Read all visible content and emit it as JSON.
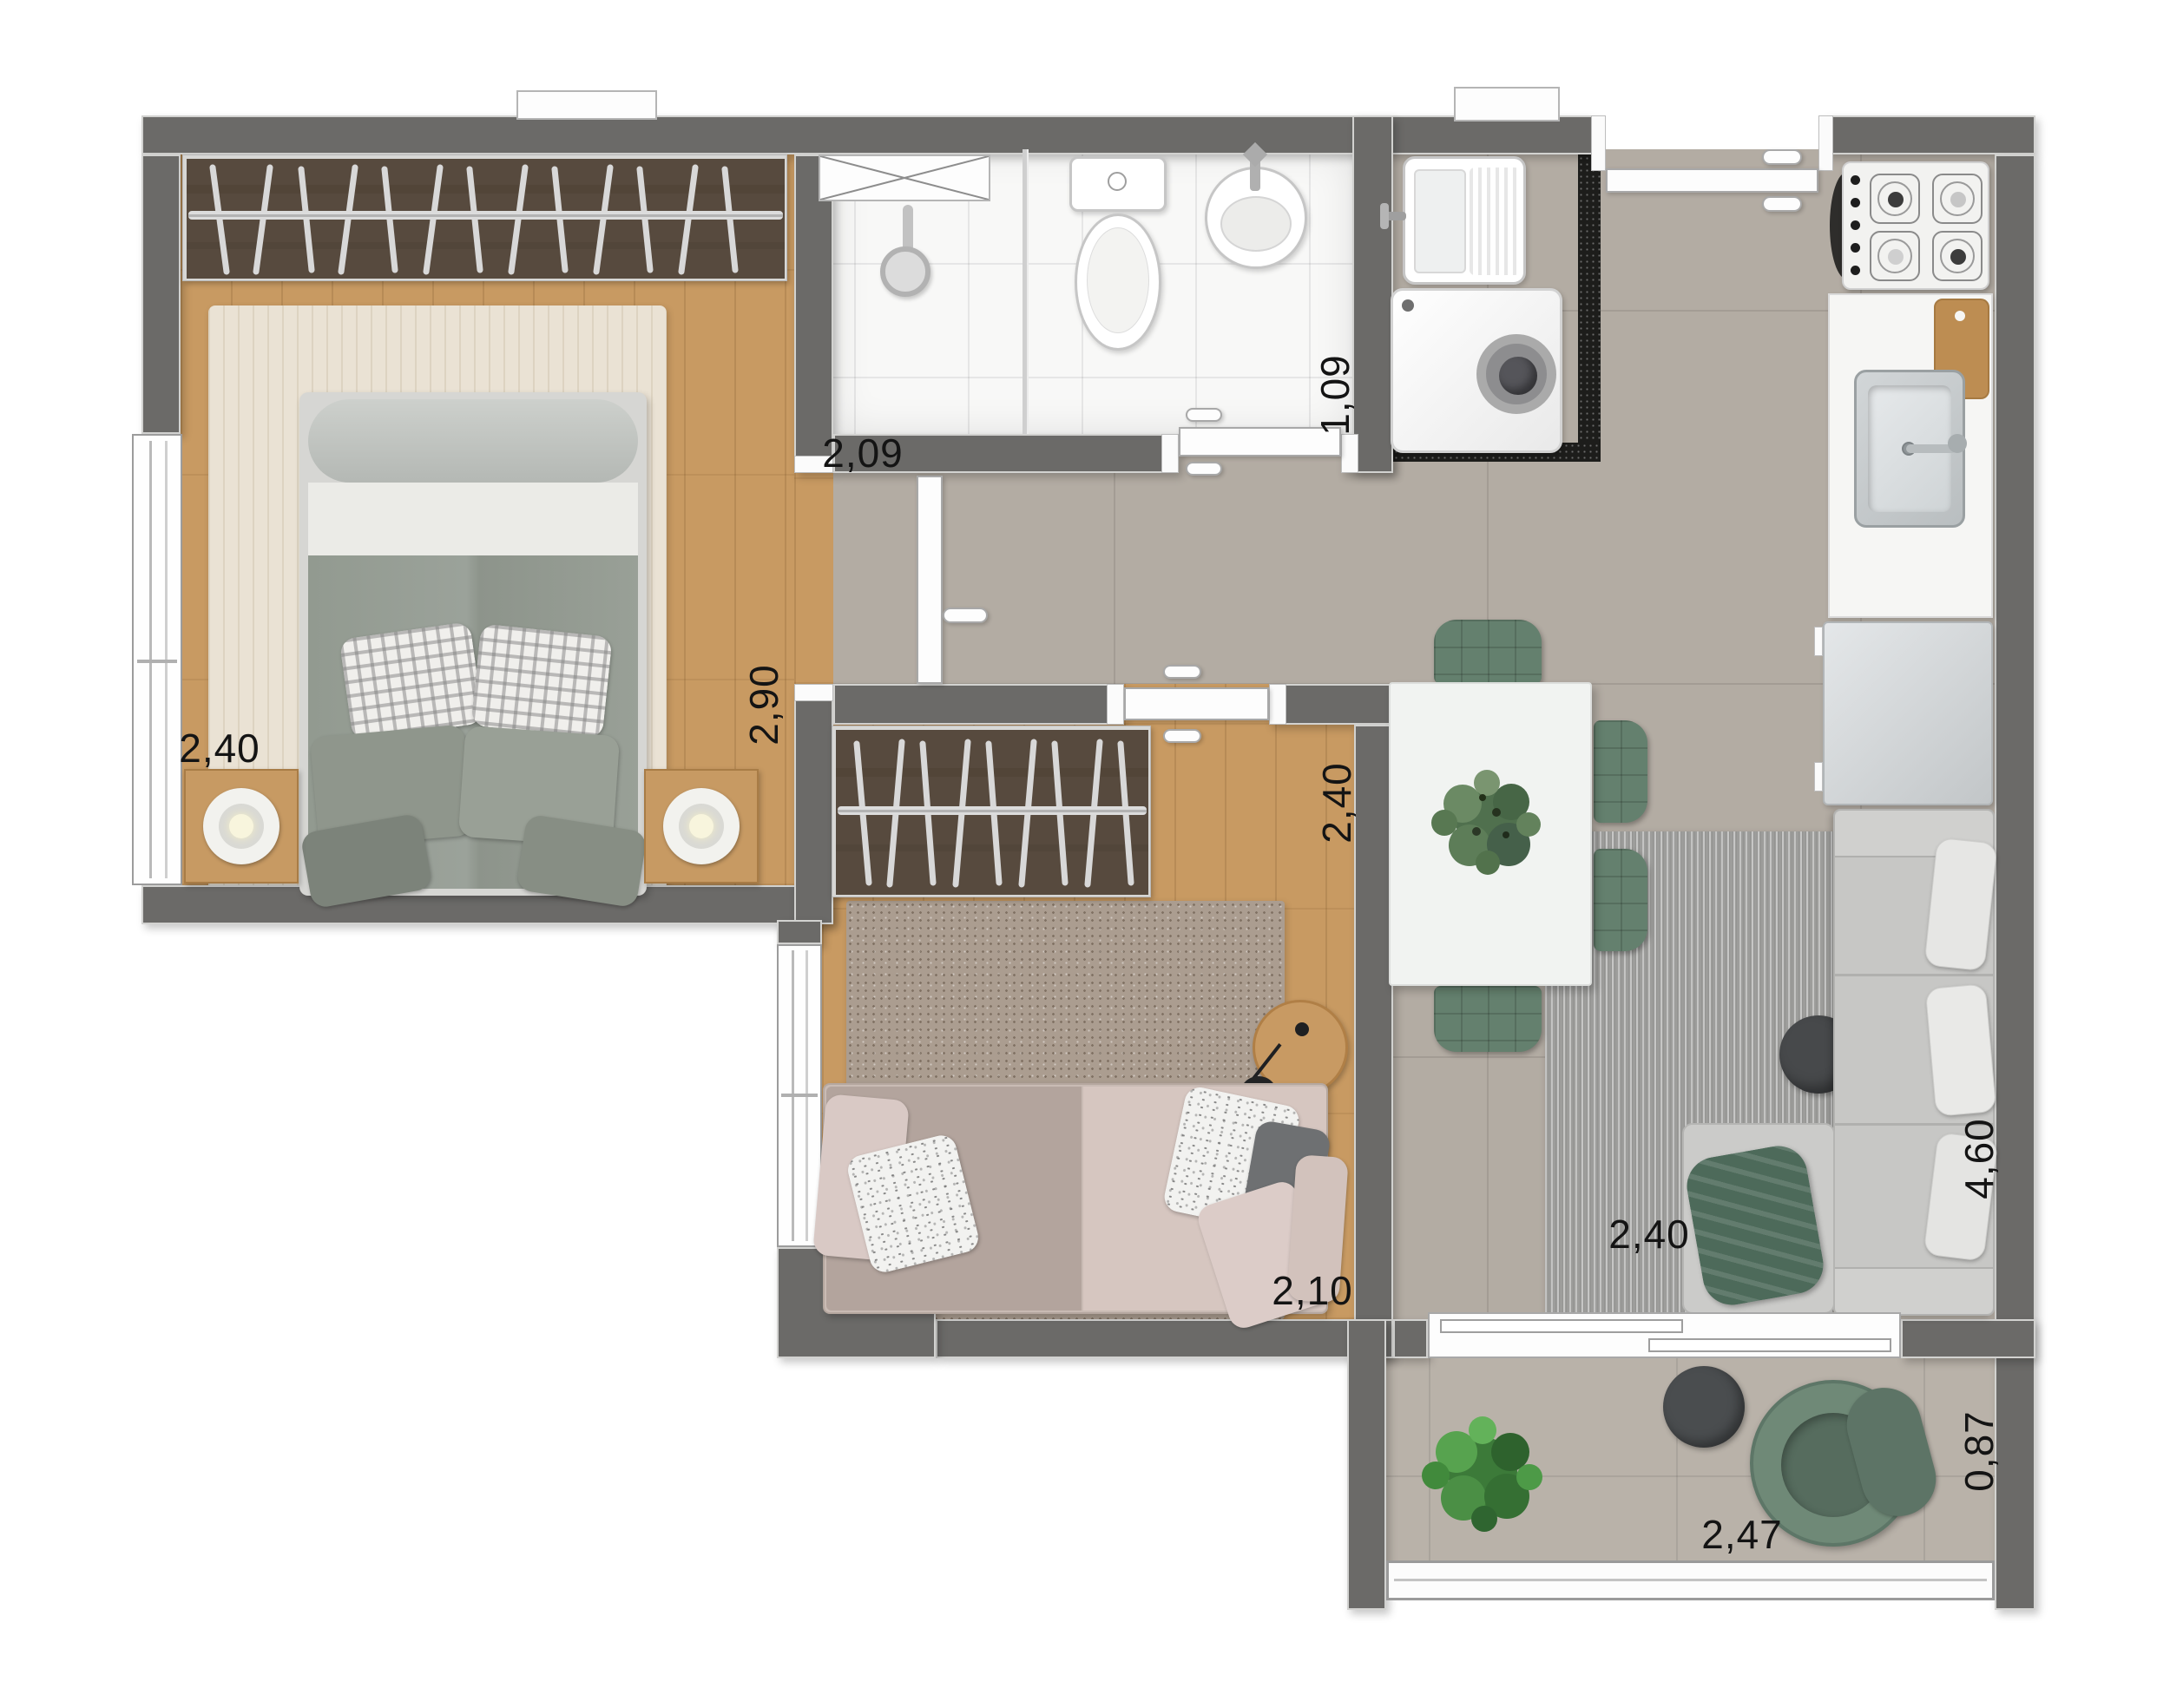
{
  "page": {
    "title": "Apartment floor plan – top view render"
  },
  "dimension_labels": {
    "bedroom1_width": "2,40",
    "bedroom1_depth": "2,90",
    "bathroom_width": "2,09",
    "bathroom_depth": "1,09",
    "bedroom2_width": "2,10",
    "bedroom2_depth": "2,40",
    "living_width": "2,40",
    "living_depth": "4,60",
    "balcony_width": "2,47",
    "balcony_depth": "0,87"
  },
  "colors": {
    "wall": "#6b6a68",
    "wood_floor": "#c89a62",
    "tile_floor": "#b3aca3",
    "bathroom_floor": "#f8f8f7",
    "bedroom1_rug": "#eae2d4",
    "bedroom2_rug": "#ab9d90",
    "living_rug": "#9d9d9b",
    "accent_green": "#64806e",
    "counter_white": "#f6f6f4",
    "granite_black": "#1d1d1b"
  },
  "objects": [
    "wardrobe-closet",
    "double-bed",
    "nightstand-lamp",
    "window",
    "shower",
    "toilet",
    "washbasin",
    "ventilation-shaft",
    "laundry-sink",
    "washing-machine",
    "gas-stove",
    "kitchen-counter",
    "kitchen-sink",
    "cutting-board",
    "refrigerator",
    "dining-table",
    "dining-chair",
    "table-plant",
    "living-rug",
    "coffee-table",
    "sofa",
    "chaise",
    "throw-blanket",
    "sofa-bed",
    "reading-lamp",
    "side-table",
    "balcony-armchair",
    "balcony-plant",
    "sliding-door",
    "entry-door",
    "interior-door",
    "balcony-railing"
  ]
}
